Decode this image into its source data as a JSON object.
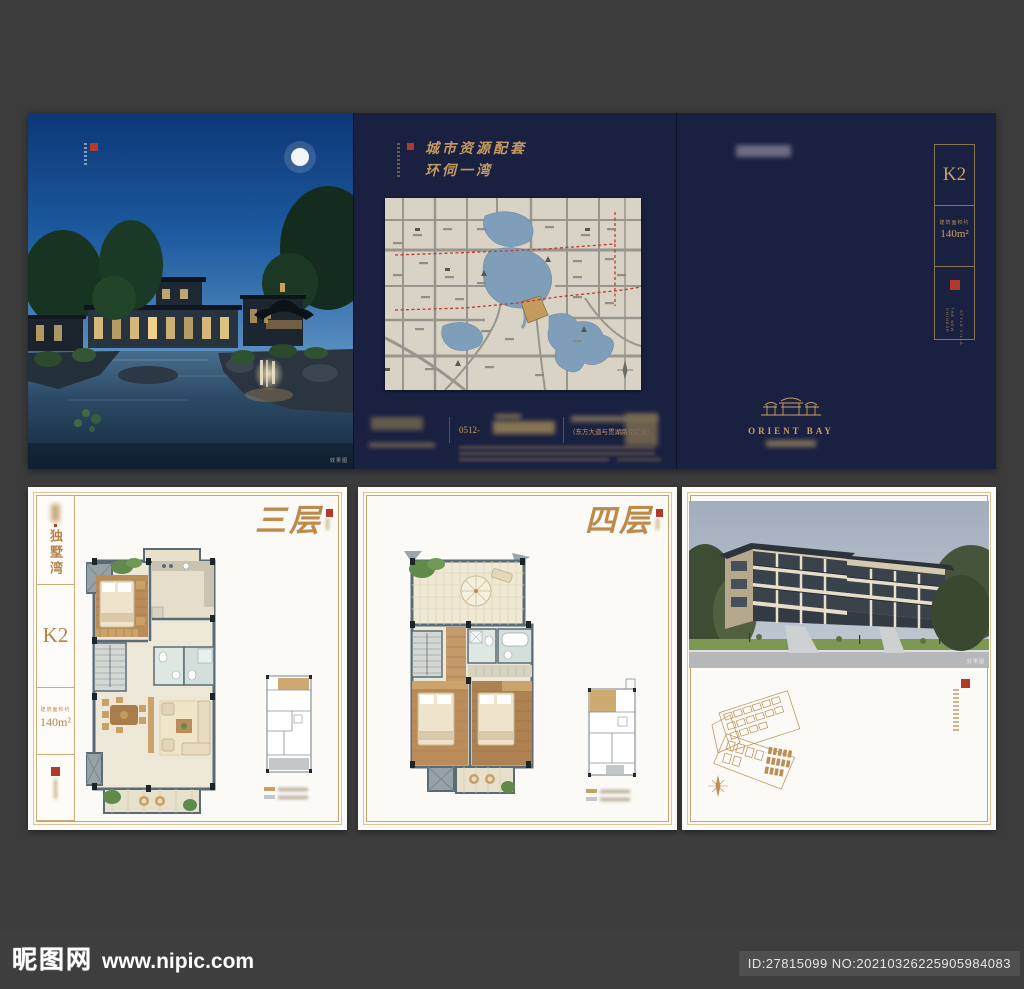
{
  "top": {
    "photo": {
      "caption": "效果图"
    },
    "map": {
      "title1": "城市资源配套",
      "title2": "环伺一湾",
      "phone_prefix": "0512-",
      "address": "（东方大道与贯湖路交汇处）"
    },
    "k2": {
      "unit": "K2",
      "area_label": "建筑面积约",
      "area_value": "140m²",
      "villa1": "THE NEW CHINESE",
      "villa2": "STYLE VILLA",
      "brand": "ORIENT BAY"
    }
  },
  "bottom": {
    "left": {
      "project": "独墅湾",
      "unit": "K2",
      "area_label": "建筑面积约",
      "area_value": "140m²",
      "title": "三层"
    },
    "middle": {
      "title": "四层"
    },
    "right": {
      "caption": "效果图"
    }
  },
  "footer": {
    "logo": "昵图网",
    "url": "www.nipic.com",
    "id": "ID:27815099 NO:20210326225905984083"
  },
  "colors": {
    "navy": "#1a2040",
    "gold": "#c9a063",
    "seal_red": "#b23a2c",
    "paper": "#fbfaf7"
  }
}
